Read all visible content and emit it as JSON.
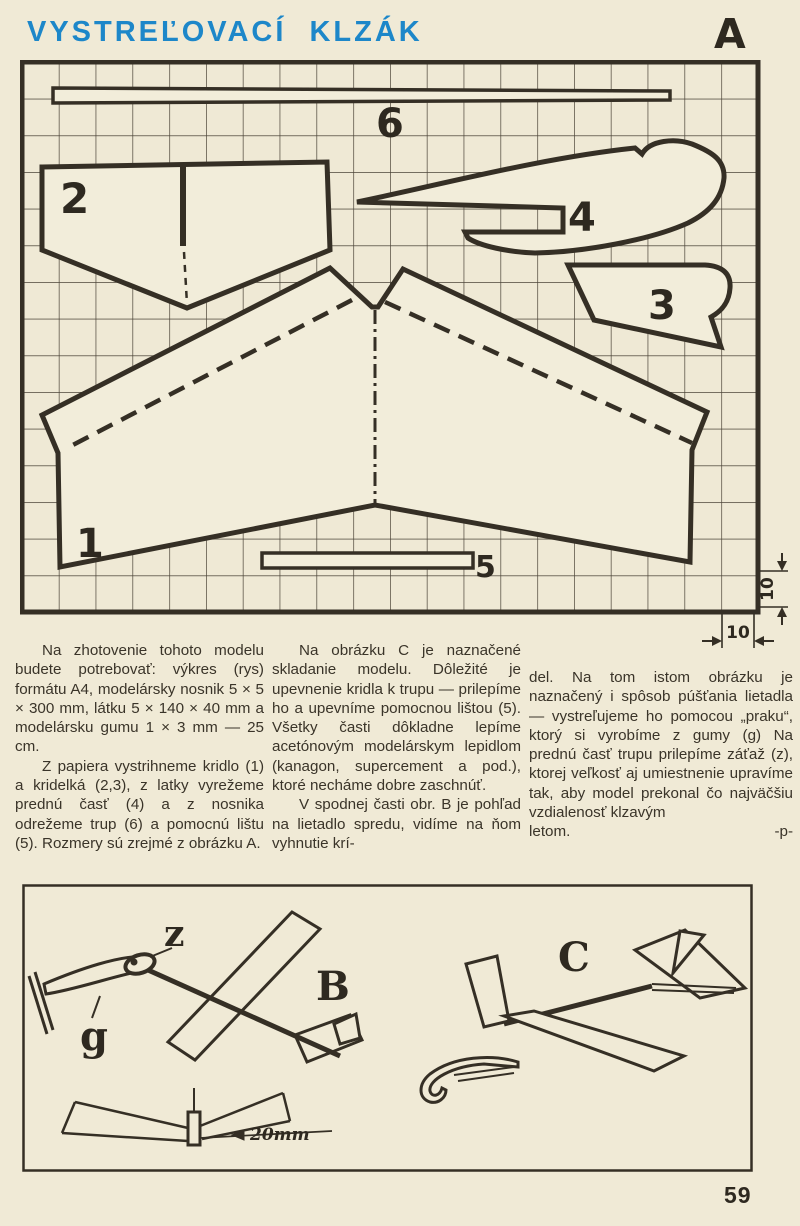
{
  "page": {
    "title": "VYSTREĽOVACÍ KLZÁK",
    "page_number": "59"
  },
  "plan": {
    "figure_label": "A",
    "part_labels": {
      "part1": "1",
      "part2": "2",
      "part3": "3",
      "part4": "4",
      "part5": "5",
      "part6": "6"
    },
    "dim_bottom": "10",
    "dim_right": "10"
  },
  "article": {
    "col1_p1": "Na zhotovenie tohoto modelu budete potrebovať: výkres (rys) formátu A4, modelársky nosnik 5 × 5 × 300 mm, látku 5 × 140 × 40 mm a modelársku gumu 1 × 3 mm — 25 cm.",
    "col1_p2": "Z papiera vystrihneme kridlo (1) a kridelká (2,3), z latky vyrežeme prednú časť (4) a z nosnika odrežeme trup (6) a pomocnú lištu (5). Rozmery sú zrejmé z obrázku A.",
    "col2_p1": "Na obrázku C je naznačené skladanie modelu. Dôležité je upevnenie kridla k trupu — prilepíme ho a upevníme pomocnou lištou (5). Všetky časti dôkladne lepíme acetónovým modelárskym lepidlom (kanagon, supercement a pod.), ktoré necháme dobre zaschnúť.",
    "col2_p2": "V spodnej časti obr. B je pohľad na lietadlo spredu, vidíme na ňom vyhnutie krí-",
    "col3_p1": "del. Na tom istom obrázku je naznačený i spôsob púšťania lietadla — vystreľujeme ho pomocou „praku“, ktorý si vyrobíme z gumy (g) Na prednú časť trupu prilepíme záťaž (z), ktorej veľkosť aj umiestnenie upravíme tak, aby model prekonal čo najväčšiu vzdialenosť klzavým",
    "col3_last": "letom.",
    "signature": "-p-"
  },
  "figure_bc": {
    "label_b": "B",
    "label_c": "C",
    "label_z": "z",
    "label_g": "g",
    "dimension": "20mm"
  }
}
